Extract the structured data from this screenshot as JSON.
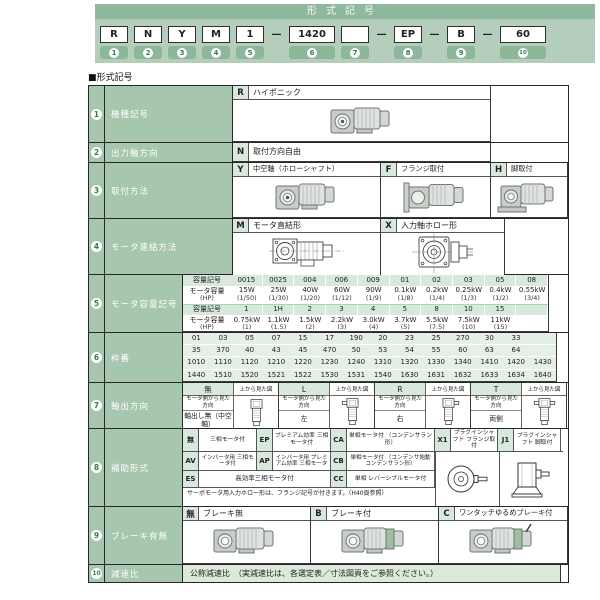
{
  "section_label": "■形式記号",
  "header": {
    "title": "形式記号",
    "slots": [
      {
        "type": "box",
        "code": "R",
        "badge": "1"
      },
      {
        "type": "box",
        "code": "N",
        "badge": "2"
      },
      {
        "type": "box",
        "code": "Y",
        "badge": "3"
      },
      {
        "type": "box",
        "code": "M",
        "badge": "4"
      },
      {
        "type": "box",
        "code": "1",
        "badge": "5"
      },
      {
        "type": "dash",
        "glyph": "—"
      },
      {
        "type": "box",
        "code": "1420",
        "badge": "6",
        "wide": true
      },
      {
        "type": "box",
        "code": "",
        "badge": "7"
      },
      {
        "type": "dash",
        "glyph": "—"
      },
      {
        "type": "box",
        "code": "EP",
        "badge": "8"
      },
      {
        "type": "dash",
        "glyph": "—"
      },
      {
        "type": "box",
        "code": "B",
        "badge": "9"
      },
      {
        "type": "dash",
        "glyph": "—"
      },
      {
        "type": "box",
        "code": "60",
        "badge": "10",
        "wide": true
      }
    ]
  },
  "rows": [
    {
      "no": "1",
      "label": "機種記号",
      "code": "R",
      "desc": "ハイポニック"
    },
    {
      "no": "2",
      "label": "出力軸方向",
      "code": "N",
      "desc": "取付方向自由"
    },
    {
      "no": "3",
      "label": "取付方法",
      "options": [
        {
          "code": "Y",
          "desc": "中空軸（ホローシャフト）"
        },
        {
          "code": "F",
          "desc": "フランジ取付"
        },
        {
          "code": "H",
          "desc": "脚取付"
        }
      ]
    },
    {
      "no": "4",
      "label": "モータ連結方法",
      "options": [
        {
          "code": "M",
          "desc": "モータ直結形"
        },
        {
          "code": "X",
          "desc": "入力軸ホロー形"
        }
      ]
    },
    {
      "no": "5",
      "label": "モータ容量記号",
      "capacity": {
        "code_header": "容量記号",
        "value_header": "モータ容量",
        "value_header_sub": "(HP)",
        "group1": {
          "codes": [
            "0015",
            "0025",
            "004",
            "006",
            "009",
            "01",
            "02",
            "03",
            "05",
            "08"
          ],
          "watts": [
            "15W",
            "25W",
            "40W",
            "60W",
            "90W",
            "0.1kW",
            "0.2kW",
            "0.25kW",
            "0.4kW",
            "0.55kW"
          ],
          "hps": [
            "(1/50)",
            "(1/30)",
            "(1/20)",
            "(1/12)",
            "(1/9)",
            "(1/8)",
            "(1/4)",
            "(1/3)",
            "(1/2)",
            "(3/4)"
          ]
        },
        "group2": {
          "codes": [
            "1",
            "1H",
            "2",
            "3",
            "4",
            "5",
            "8",
            "10",
            "15"
          ],
          "watts": [
            "0.75kW",
            "1.1kW",
            "1.5kW",
            "2.2kW",
            "3.0kW",
            "3.7kW",
            "5.5kW",
            "7.5kW",
            "11kW"
          ],
          "hps": [
            "(1)",
            "(1.5)",
            "(2)",
            "(3)",
            "(4)",
            "(5)",
            "(7.5)",
            "(10)",
            "(15)"
          ]
        }
      }
    },
    {
      "no": "6",
      "label": "枠番",
      "lines": [
        [
          "01",
          "03",
          "05",
          "07",
          "15",
          "17",
          "190",
          "20",
          "23",
          "25",
          "270",
          "30",
          "33"
        ],
        [
          "35",
          "370",
          "40",
          "43",
          "45",
          "470",
          "50",
          "53",
          "54",
          "55",
          "60",
          "63",
          "64"
        ],
        [
          "1010",
          "1110",
          "1120",
          "1210",
          "1220",
          "1230",
          "1240",
          "1310",
          "1320",
          "1330",
          "1340",
          "1410",
          "1420",
          "1430"
        ],
        [
          "1440",
          "1510",
          "1520",
          "1521",
          "1522",
          "1530",
          "1531",
          "1540",
          "1630",
          "1631",
          "1632",
          "1633",
          "1634",
          "1640"
        ]
      ]
    },
    {
      "no": "7",
      "label": "軸出方向",
      "view_label": "上から見た図",
      "dir_label": "モータ側から見た方向",
      "columns": [
        {
          "code": "無",
          "value": "軸出し無（中空軸）",
          "img": "topNone"
        },
        {
          "code": "L",
          "value": "左",
          "img": "topL"
        },
        {
          "code": "R",
          "value": "右",
          "img": "topR"
        },
        {
          "code": "T",
          "value": "両側",
          "img": "topT"
        }
      ]
    },
    {
      "no": "8",
      "label": "補助形式",
      "line1": [
        {
          "code": "無",
          "desc": "三相モータ付",
          "w": 58
        },
        {
          "code": "EP",
          "desc": "プレミアム効率 三相モータ付",
          "w": 58
        },
        {
          "code": "CA",
          "desc": "単相モータ付 （コンデンサラン形）",
          "w": 88
        },
        {
          "code": "X1",
          "desc": "プラグインシャフト フランジ取付",
          "w": 47
        },
        {
          "code": "J1",
          "desc": "プラグインシャフト 脚取付",
          "w": 47
        }
      ],
      "line2": [
        {
          "code": "AV",
          "desc": "インバータ用 三相モータ付",
          "w": 58
        },
        {
          "code": "AP",
          "desc": "インバータ用 プレミアム効率 三相モータ",
          "w": 58
        },
        {
          "code": "CB",
          "desc": "単相モータ付 （コンデンサ始動コンデンサラン形）",
          "w": 88
        }
      ],
      "line3": [
        {
          "code": "ES",
          "desc": "高効率三相モータ付",
          "w": 132
        },
        {
          "code": "CC",
          "desc": "単相 レバーシブルモータ付",
          "w": 88
        }
      ],
      "note": "サーボモータ用入力ホロー形は、フランジ記号が付きます。（H40頁参照）"
    },
    {
      "no": "9",
      "label": "ブレーキ有無",
      "options": [
        {
          "code": "無",
          "desc": "ブレーキ無"
        },
        {
          "code": "B",
          "desc": "ブレーキ付"
        },
        {
          "code": "C",
          "desc": "ワンタッチゆるめブレーキ付"
        }
      ]
    },
    {
      "no": "10",
      "label": "減速比",
      "desc": "公称減速比　（実減速比は、各選定表／寸法図頁をご参照ください。）"
    }
  ],
  "colors": {
    "title_bar_green": "#8fb99d",
    "band_green": "#b4cebb",
    "badge_green": "#8cb798",
    "label_cell_green": "#a6c6ae",
    "light_green_cell": "#d9e8dc",
    "pale_green_cell": "#e4f0e5",
    "number_green": "#2f7d52"
  }
}
